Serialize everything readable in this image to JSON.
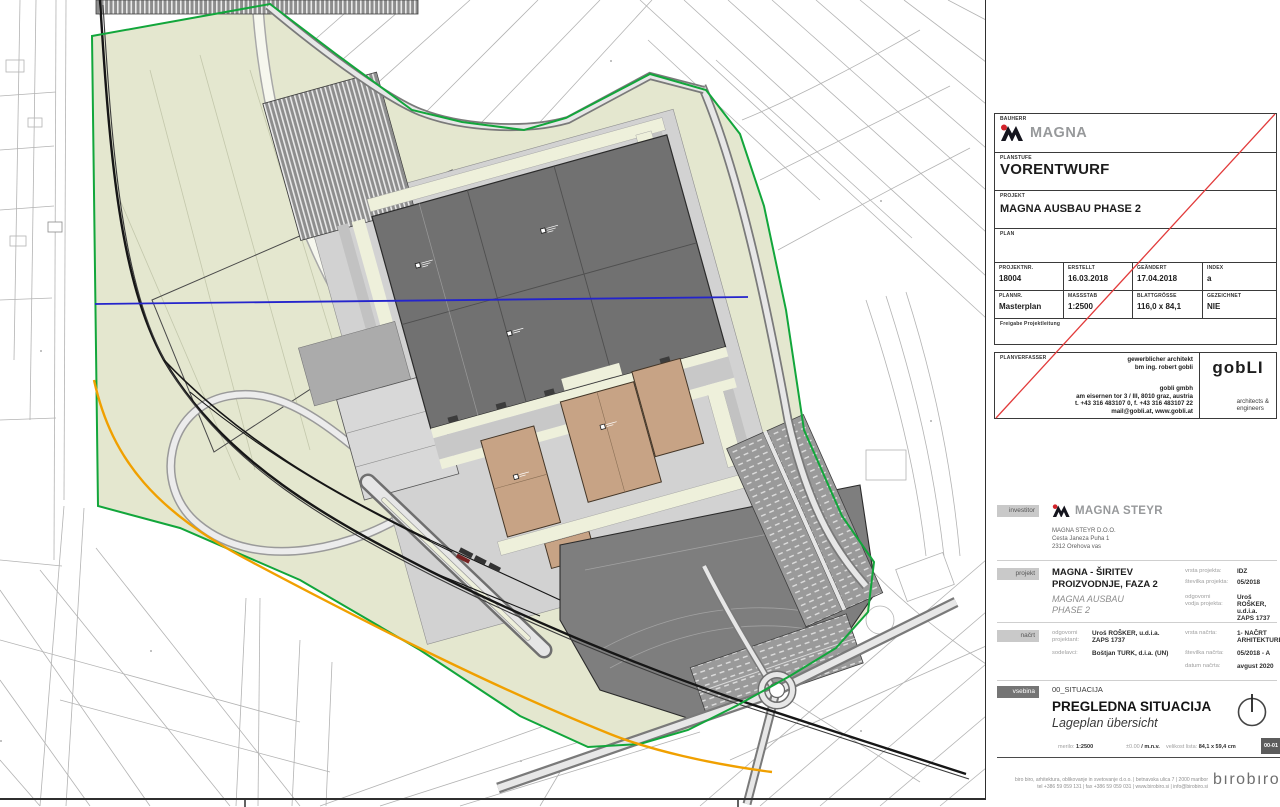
{
  "title_block": {
    "bauherr_label": "BAUHERR",
    "brand": "MAGNA",
    "planstufe_label": "PLANSTUFE",
    "planstufe": "VORENTWURF",
    "projekt_label": "PROJEKT",
    "projekt": "MAGNA AUSBAU PHASE 2",
    "plan_label": "PLAN",
    "fields": [
      {
        "label": "PROJEKTNR.",
        "value": "18004"
      },
      {
        "label": "ERSTELLT",
        "value": "16.03.2018"
      },
      {
        "label": "GEÄNDERT",
        "value": "17.04.2018"
      },
      {
        "label": "INDEX",
        "value": "a"
      },
      {
        "label": "PLANNR.",
        "value": "Masterplan"
      },
      {
        "label": "MASSSTAB",
        "value": "1:2500"
      },
      {
        "label": "BLATTGRÖSSE",
        "value": "116,0 x 84,1"
      },
      {
        "label": "GEZEICHNET",
        "value": "NIE"
      }
    ],
    "freigabe_label": "Freigabe Projektleitung",
    "planverfasser_label": "PLANVERFASSER",
    "architect_title": "gewerblicher architekt",
    "architect_name": "bm ing. robert gobli",
    "firm_name": "gobli gmbh",
    "firm_address": "am eisernen tor 3 / III, 8010 graz, austria",
    "firm_phone": "t. +43 316 483107 0, f. +43 316 483107 22",
    "firm_mail": "mail@gobli.at, www.gobli.at",
    "gobli_logo": "gobLI",
    "gobli_sub1": "architects &",
    "gobli_sub2": "engineers"
  },
  "info_block": {
    "investitor_label": "investitor",
    "investitor_brand": "MAGNA STEYR",
    "investitor_company": "MAGNA STEYR D.O.O.",
    "investitor_street": "Cesta Janeza Puha 1",
    "investitor_city": "2312 Orehova vas",
    "projekt_label": "projekt",
    "project_title1": "MAGNA - ŠIRITEV",
    "project_title2": "PROIZVODNJE, FAZA 2",
    "project_sub1": "MAGNA AUSBAU",
    "project_sub2": "PHASE 2",
    "vrsta_projekta_label": "vrsta projekta:",
    "vrsta_projekta": "IDZ",
    "stevilka_projekta_label": "številka projekta:",
    "stevilka_projekta": "05/2018",
    "odg_vodja_label1": "odgovorni",
    "odg_vodja_label2": "vodja projekta:",
    "odg_vodja_name": "Uroš ROŠKER, u.d.i.a.",
    "odg_vodja_id": "ZAPS 1737",
    "nacrt_label": "načrt",
    "odg_projektant_label1": "odgovorni",
    "odg_projektant_label2": "projektant:",
    "odg_projektant_name": "Uroš ROŠKER, u.d.i.a.",
    "odg_projektant_id": "ZAPS 1737",
    "sodelavci_label": "sodelavci:",
    "sodelavci": "Boštjan TURK, d.i.a. (UN)",
    "vrsta_nacrta_label": "vrsta načrta:",
    "vrsta_nacrta": "1- NAČRT ARHITEKTURE,",
    "stevilka_nacrta_label": "številka načrta:",
    "stevilka_nacrta": "05/2018 - A",
    "datum_nacrta_label": "datum načrta:",
    "datum_nacrta": "avgust 2020",
    "vsebina_label": "vsebina",
    "map_code": "00_SITUACIJA",
    "map_title": "PREGLEDNA SITUACIJA",
    "map_subtitle": "Lageplan übersicht",
    "merilo_label": "merilo:",
    "merilo": "1:2500",
    "elevation_label": "±0.00",
    "elevation_value": "/ m.n.v.",
    "velikost_label": "velikost lista:",
    "velikost": "84,1 x 59,4 cm",
    "sheet_badge": "00-01",
    "footer_line1": "biro biro, arhitektura, oblikovanje in svetovanje d.o.o. | betnavska ulica 7 | 2000 maribor",
    "footer_line2": "tel +386 59 059 131 | fax +386 59 059 031 | www.birobiro.si | info@birobiro.si",
    "birobiro_logo": "bırobıro"
  },
  "map": {
    "colors": {
      "site_green_fill": "#e4e7cf",
      "boundary_green": "#12a63b",
      "orange_utility_line": "#f0a000",
      "blue_section_line": "#2424cc",
      "existing_hall_gray": "#717171",
      "new_building_tan": "#c7a385",
      "asphalt_gray": "#d2d2d2",
      "rail_black": "#161616",
      "parcel_line_gray": "#b3b3b3",
      "revision_cross_red": "#e23b3b",
      "magna_red": "#d2232a"
    }
  }
}
